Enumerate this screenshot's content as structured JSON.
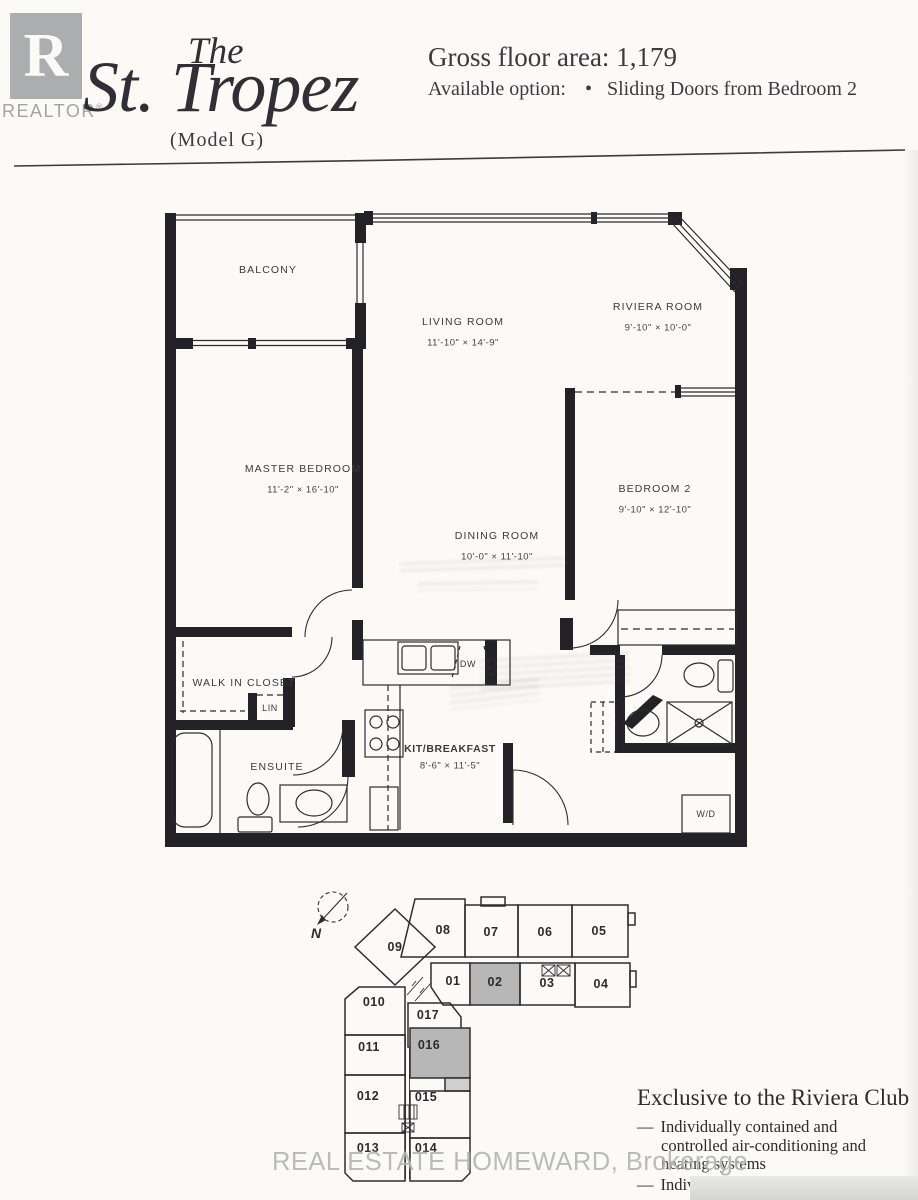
{
  "colors": {
    "paper": "#fbfaf6",
    "ink": "#3a3a3e",
    "wall": "#232327",
    "logo_gray": "#acadaf",
    "highlight_unit": "#b7b7b7",
    "watermark_gray": "#a8ada5"
  },
  "header": {
    "logo": {
      "letter": "R",
      "brand": "REALTOR",
      "registered": "®"
    },
    "title": {
      "the": "The",
      "name": "St. Tropez",
      "model": "(Model G)"
    },
    "gross_floor_area_label": "Gross floor area:",
    "gross_floor_area_value": "1,179",
    "available_option_label": "Available option:",
    "available_option_bullet": "•",
    "available_option_value": "Sliding Doors from Bedroom 2"
  },
  "floorplan": {
    "rooms": {
      "balcony": {
        "name": "BALCONY",
        "dims": ""
      },
      "living": {
        "name": "LIVING ROOM",
        "dims": "11'-10\" × 14'-9\""
      },
      "riviera": {
        "name": "RIVIERA ROOM",
        "dims": "9'-10\" × 10'-0\""
      },
      "master": {
        "name": "MASTER BEDROOM",
        "dims": "11'-2\" × 16'-10\""
      },
      "bedroom2": {
        "name": "BEDROOM 2",
        "dims": "9'-10\" × 12'-10\""
      },
      "dining": {
        "name": "DINING ROOM",
        "dims": "10'-0\" × 11'-10\""
      },
      "kitchen": {
        "name": "KIT/BREAKFAST",
        "dims": "8'-6\" × 11'-5\""
      },
      "walkin": {
        "name": "WALK IN CLOSET",
        "dims": ""
      },
      "lin": {
        "name": "LIN",
        "dims": ""
      },
      "ensuite": {
        "name": "ENSUITE",
        "dims": ""
      },
      "dw": {
        "name": "DW",
        "dims": ""
      },
      "wd": {
        "name": "W/D",
        "dims": ""
      }
    }
  },
  "keyplan": {
    "north": "N",
    "units": [
      {
        "label": "09",
        "highlighted": false
      },
      {
        "label": "08",
        "highlighted": false
      },
      {
        "label": "07",
        "highlighted": false
      },
      {
        "label": "06",
        "highlighted": false
      },
      {
        "label": "05",
        "highlighted": false
      },
      {
        "label": "01",
        "highlighted": false
      },
      {
        "label": "02",
        "highlighted": true
      },
      {
        "label": "03",
        "highlighted": false
      },
      {
        "label": "04",
        "highlighted": false
      },
      {
        "label": "010",
        "highlighted": false
      },
      {
        "label": "017",
        "highlighted": false
      },
      {
        "label": "011",
        "highlighted": false
      },
      {
        "label": "016",
        "highlighted": true
      },
      {
        "label": "012",
        "highlighted": false
      },
      {
        "label": "015",
        "highlighted": false
      },
      {
        "label": "013",
        "highlighted": false
      },
      {
        "label": "014",
        "highlighted": false
      }
    ]
  },
  "notes": {
    "title": "Exclusive to the Riviera Club",
    "bullets": [
      {
        "dash": "—",
        "text": "Individually contained and controlled air-conditioning and heating systems"
      },
      {
        "dash": "—",
        "text": "Individual hydro meters"
      }
    ]
  },
  "watermark": "REAL ESTATE HOMEWARD, Brokerage"
}
